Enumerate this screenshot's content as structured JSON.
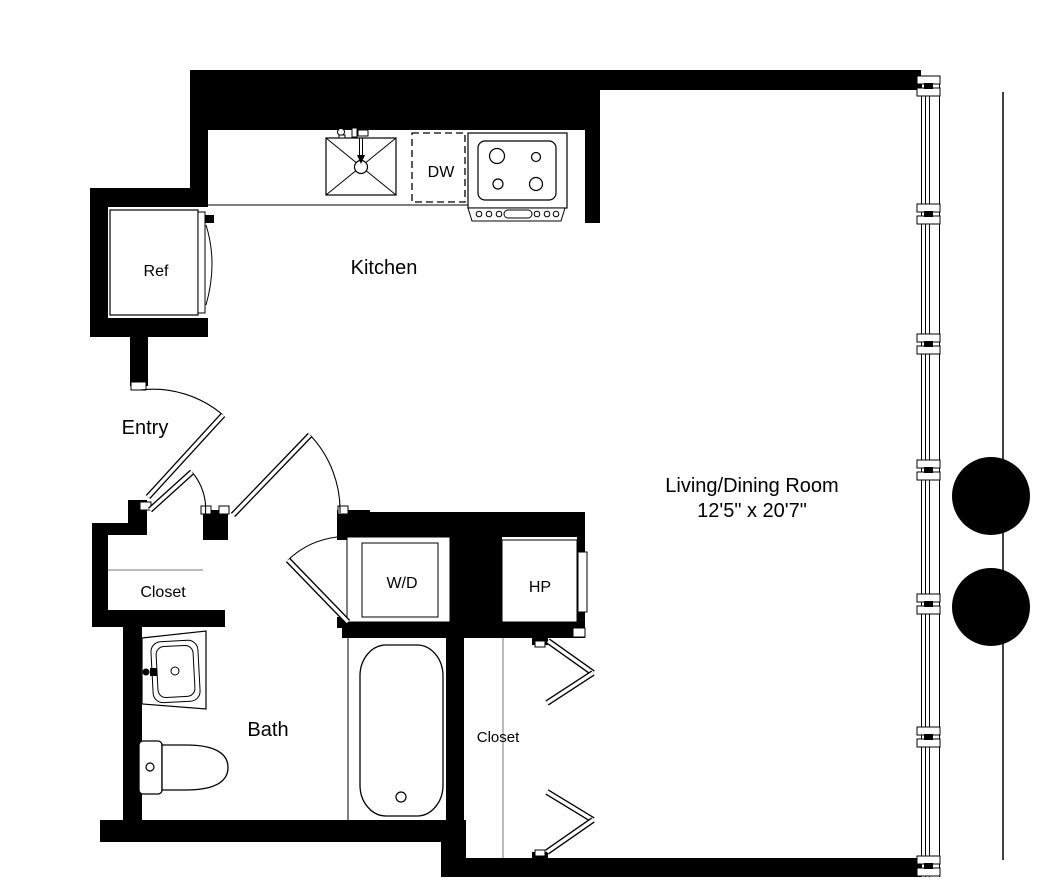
{
  "rooms": {
    "kitchen": {
      "label": "Kitchen"
    },
    "entry": {
      "label": "Entry"
    },
    "bath": {
      "label": "Bath"
    },
    "entry_closet": {
      "label": "Closet"
    },
    "hall_closet": {
      "label": "Closet"
    },
    "living_dining": {
      "label": "Living/Dining Room",
      "dimensions": "12'5\" x 20'7\""
    }
  },
  "fixtures": {
    "refrigerator": {
      "label": "Ref"
    },
    "dishwasher": {
      "label": "DW"
    },
    "washer_dryer": {
      "label": "W/D"
    },
    "heat_pump": {
      "label": "HP"
    }
  },
  "colors": {
    "walls": "#000000",
    "lines": "#000000",
    "closet_lines": "#777777",
    "background": "#ffffff"
  }
}
